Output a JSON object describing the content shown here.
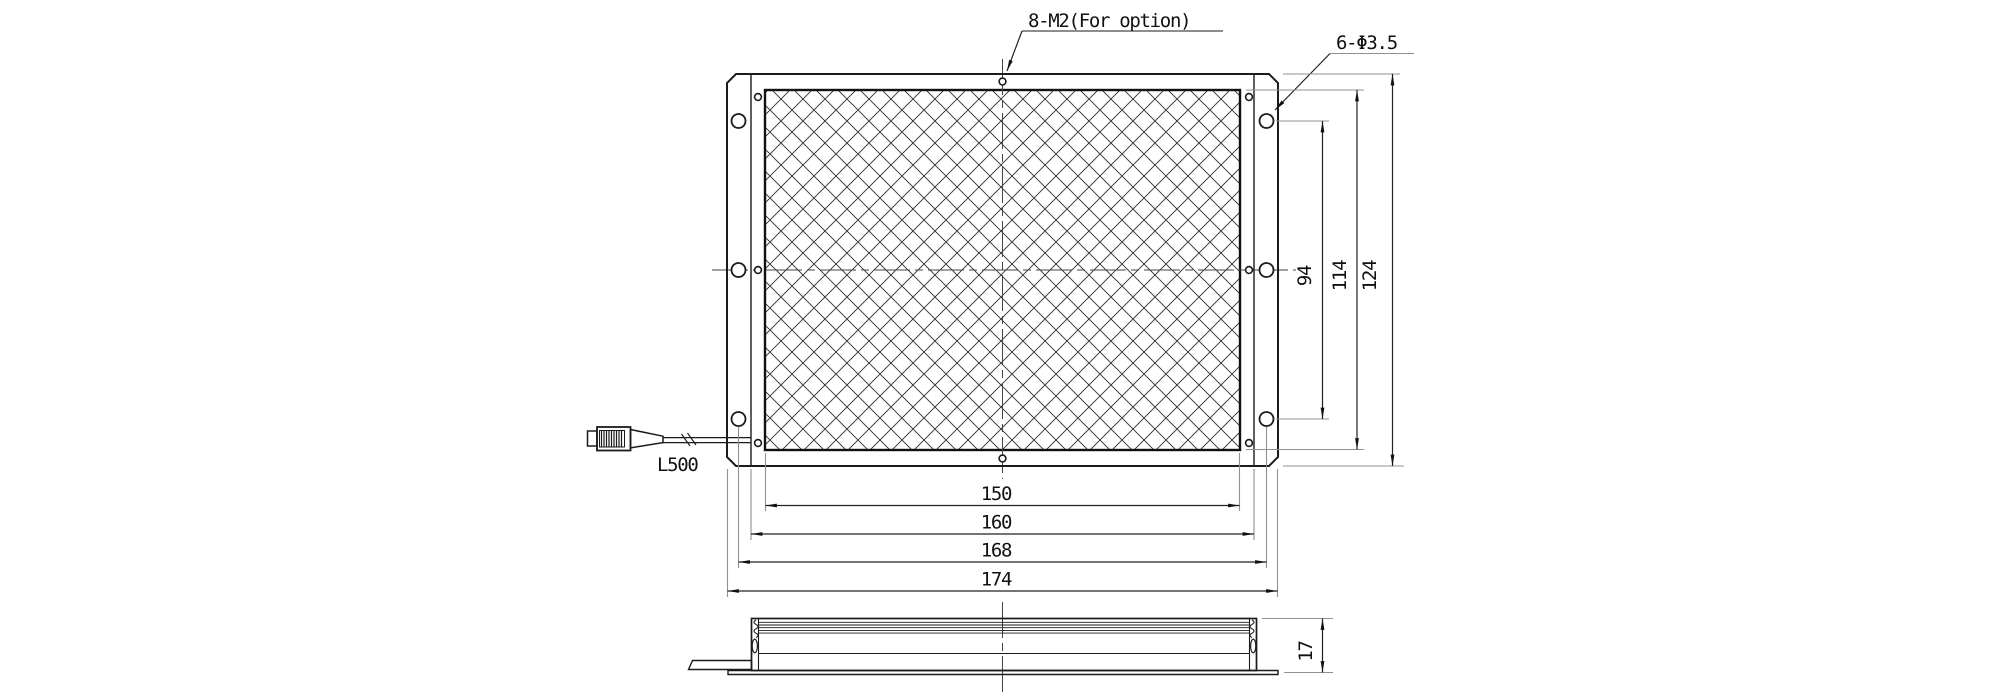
{
  "annotations": {
    "tapped_holes_note": "8-M2(For option)",
    "clearance_holes_note": "6-Φ3.5",
    "cable_length_label": "L500"
  },
  "dimensions": {
    "bottom_widths": [
      "150",
      "160",
      "168",
      "174"
    ],
    "right_heights": [
      "94",
      "114",
      "124"
    ],
    "side_thickness": "17"
  },
  "colors": {
    "background": "#ffffff",
    "line": "#1b1b1b",
    "extension_line": "#909090",
    "text": "#111111"
  }
}
